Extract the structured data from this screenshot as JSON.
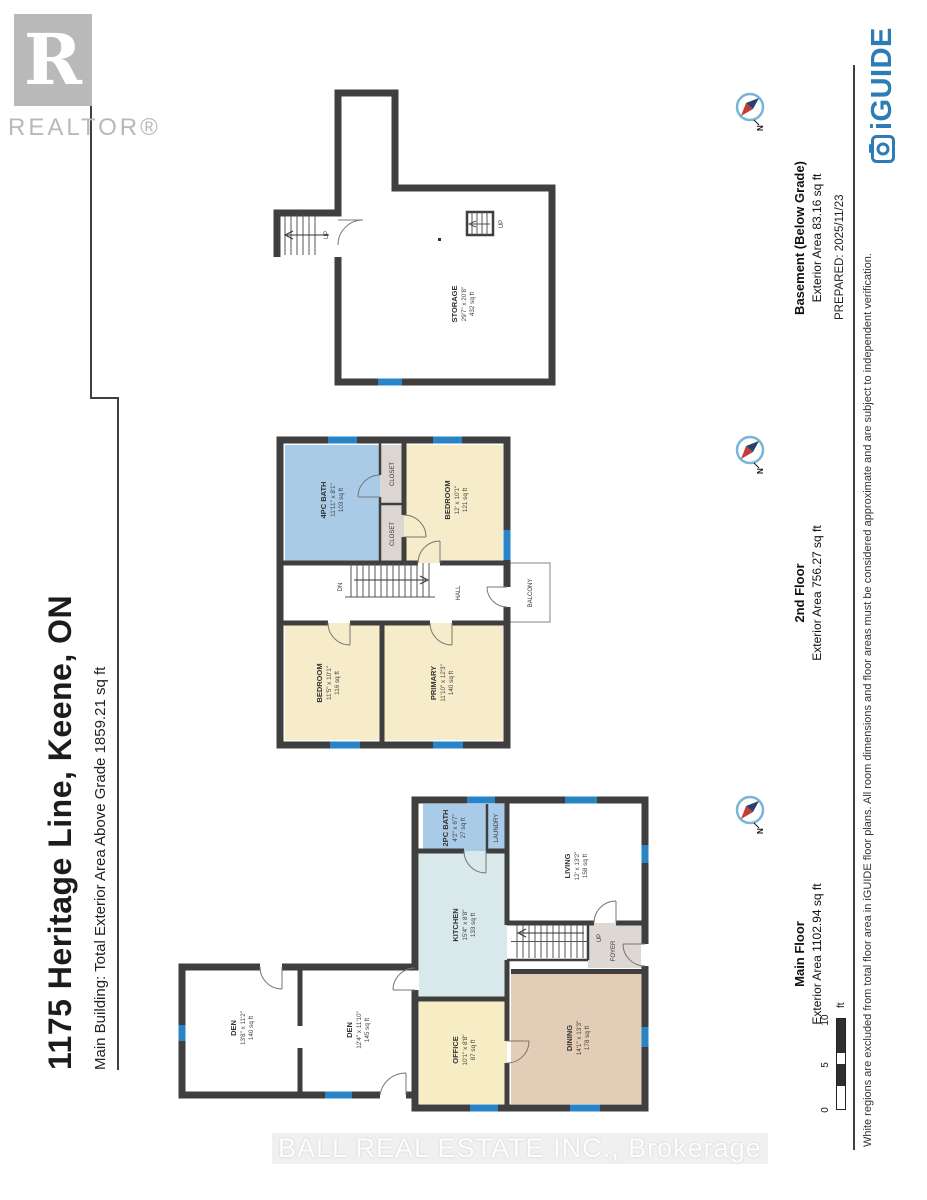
{
  "header": {
    "title": "1175 Heritage Line, Keene, ON",
    "subtitle": "Main Building: Total Exterior Area Above Grade 1859.21 sq ft"
  },
  "footer": {
    "prepared": "PREPARED: 2025/11/23",
    "disclaimer": "White regions are excluded from total floor area in iGUIDE floor plans. All room dimensions and floor areas must be considered approximate and are subject to independent verification.",
    "iguide": "iGUIDE"
  },
  "overlays": {
    "realtor_r": "R",
    "realtor": "REALTOR®",
    "watermark": "BALL REAL ESTATE INC., Brokerage"
  },
  "scalebar": {
    "zero": "0",
    "five": "5",
    "ten": "10",
    "unit": "ft"
  },
  "compass_n": "N",
  "colors": {
    "wall": "#3f3f3f",
    "window": "#2984c7",
    "bath_blue": "#a9cbe8",
    "kitchen_blue": "#d9e8ea",
    "bedroom_cream": "#f7ecca",
    "office_yellow": "#f6edc4",
    "dining_tan": "#e3cdb6",
    "closet_gray": "#dbd6d2",
    "iguide_blue": "#2d7cb5",
    "realtor_gray": "#b9b9b9"
  },
  "floors": {
    "main": {
      "label": "Main Floor",
      "area": "Exterior Area 1102.94 sq ft",
      "rooms": {
        "den1": {
          "name": "DEN",
          "dims": "13'8\" x 11'2\"",
          "area": "140 sq ft"
        },
        "den2": {
          "name": "DEN",
          "dims": "12'4\" x 11'10\"",
          "area": "145 sq ft"
        },
        "office": {
          "name": "OFFICE",
          "dims": "10'1\" x 8'8\"",
          "area": "87 sq ft"
        },
        "dining": {
          "name": "DINING",
          "dims": "14'1\" x 13'3\"",
          "area": "178 sq ft"
        },
        "kitchen": {
          "name": "KITCHEN",
          "dims": "15'4\" x 8'8\"",
          "area": "133 sq ft"
        },
        "bath": {
          "name": "2PC BATH",
          "dims": "4'2\" x 6'7\"",
          "area": "27 sq ft"
        },
        "laundry": {
          "name": "LAUNDRY"
        },
        "living": {
          "name": "LIVING",
          "dims": "12' x 13'2\"",
          "area": "158 sq ft"
        },
        "foyer": {
          "name": "FOYER"
        },
        "stairs_up": "UP"
      }
    },
    "second": {
      "label": "2nd Floor",
      "area": "Exterior Area 756.27 sq ft",
      "rooms": {
        "bath": {
          "name": "4PC BATH",
          "dims": "11'11\" x 8'1\"",
          "area": "103 sq ft"
        },
        "closet1": {
          "name": "CLOSET"
        },
        "closet2": {
          "name": "CLOSET"
        },
        "bedroom_right": {
          "name": "BEDROOM",
          "dims": "12' x 10'1\"",
          "area": "121 sq ft"
        },
        "bedroom_left": {
          "name": "BEDROOM",
          "dims": "11'5\" x 10'1\"",
          "area": "116 sq ft"
        },
        "primary": {
          "name": "PRIMARY",
          "dims": "11'10\" x 12'3\"",
          "area": "140 sq ft"
        },
        "hall": {
          "name": "HALL"
        },
        "balcony": {
          "name": "BALCONY"
        },
        "stairs_dn": "DN"
      }
    },
    "basement": {
      "label": "Basement (Below Grade)",
      "area": "Exterior Area 83.16 sq ft",
      "rooms": {
        "storage": {
          "name": "STORAGE",
          "dims": "29'7\" x 20'8\"",
          "area": "432 sq ft"
        },
        "stairs_up": "UP",
        "stairs_up2": "UP"
      }
    }
  }
}
